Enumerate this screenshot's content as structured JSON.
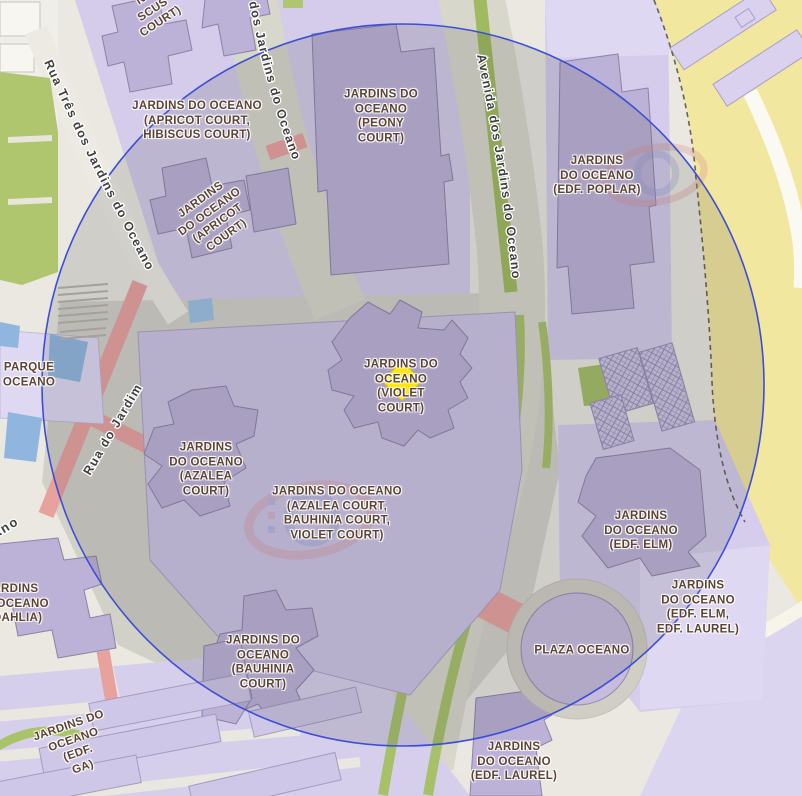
{
  "map": {
    "title": "Jardins do Oceano neighbourhood map",
    "marker": {
      "name": "selected-location-marker",
      "shape": "diamond",
      "color": "#ffe604"
    },
    "radius_circle": {
      "stroke": "#3d4ed6",
      "fill": "rgba(58,58,66,0.15)"
    },
    "palette": {
      "base": "#eae8e0",
      "road": "#d8d7cb",
      "residential": "#d4ccea",
      "residential_light": "#ded8f2",
      "building": "#bcb1d6",
      "building_outline": "#8c83a6",
      "park_green": "#afc66e",
      "stripe_green": "#a7c169",
      "sand": "#f2e79f",
      "crossing_pink": "#e8a29e",
      "water": "#90b6df",
      "label_text": "#5c4333",
      "street_text": "#3f3f3f"
    }
  },
  "labels": {
    "apricot_hibiscus": "JARDINS DO OCEANO\n(APRICOT COURT,\nHIBISCUS COURT)",
    "apricot": "JARDINS\nDO OCEANO\n(APRICOT\nCOURT)",
    "clipped_top": "NO\nSCUS\nCOURT)",
    "peony": "JARDINS DO\nOCEANO\n(PEONY\nCOURT)",
    "poplar": "JARDINS\nDO OCEANO\n(EDF. POPLAR)",
    "parque": "PARQUE\nOCEANO",
    "violet": "JARDINS DO\nOCEANO\n(VIOLET\nCOURT)",
    "azalea": "JARDINS\nDO OCEANO\n(AZALEA\nCOURT)",
    "podium": "JARDINS DO OCEANO\n(AZALEA COURT,\nBAUHINIA COURT,\nVIOLET COURT)",
    "elm": "JARDINS\nDO OCEANO\n(EDF. ELM)",
    "elm_laurel": "JARDINS\nDO OCEANO\n(EDF. ELM,\nEDF. LAUREL)",
    "plaza": "PLAZA OCEANO",
    "bauhinia": "JARDINS DO\nOCEANO\n(BAUHINIA\nCOURT)",
    "laurel": "JARDINS\nDO OCEANO\n(EDF. LAUREL)",
    "dahlia": "JARDINS\nDO OCEANO\n(. DAHLIA)",
    "edf_ga": "JARDINS DO\nOCEANO\n(EDF.\nGA)"
  },
  "streets": {
    "rua_tres": "Rua Três dos Jardins do Oceano",
    "dos_jardins": "dos Jardins do Oceano",
    "avenida": "Avenida dos Jardins do Oceano",
    "rua_do_jardim": "Rua do Jardim",
    "ano_fragment": "ano"
  }
}
